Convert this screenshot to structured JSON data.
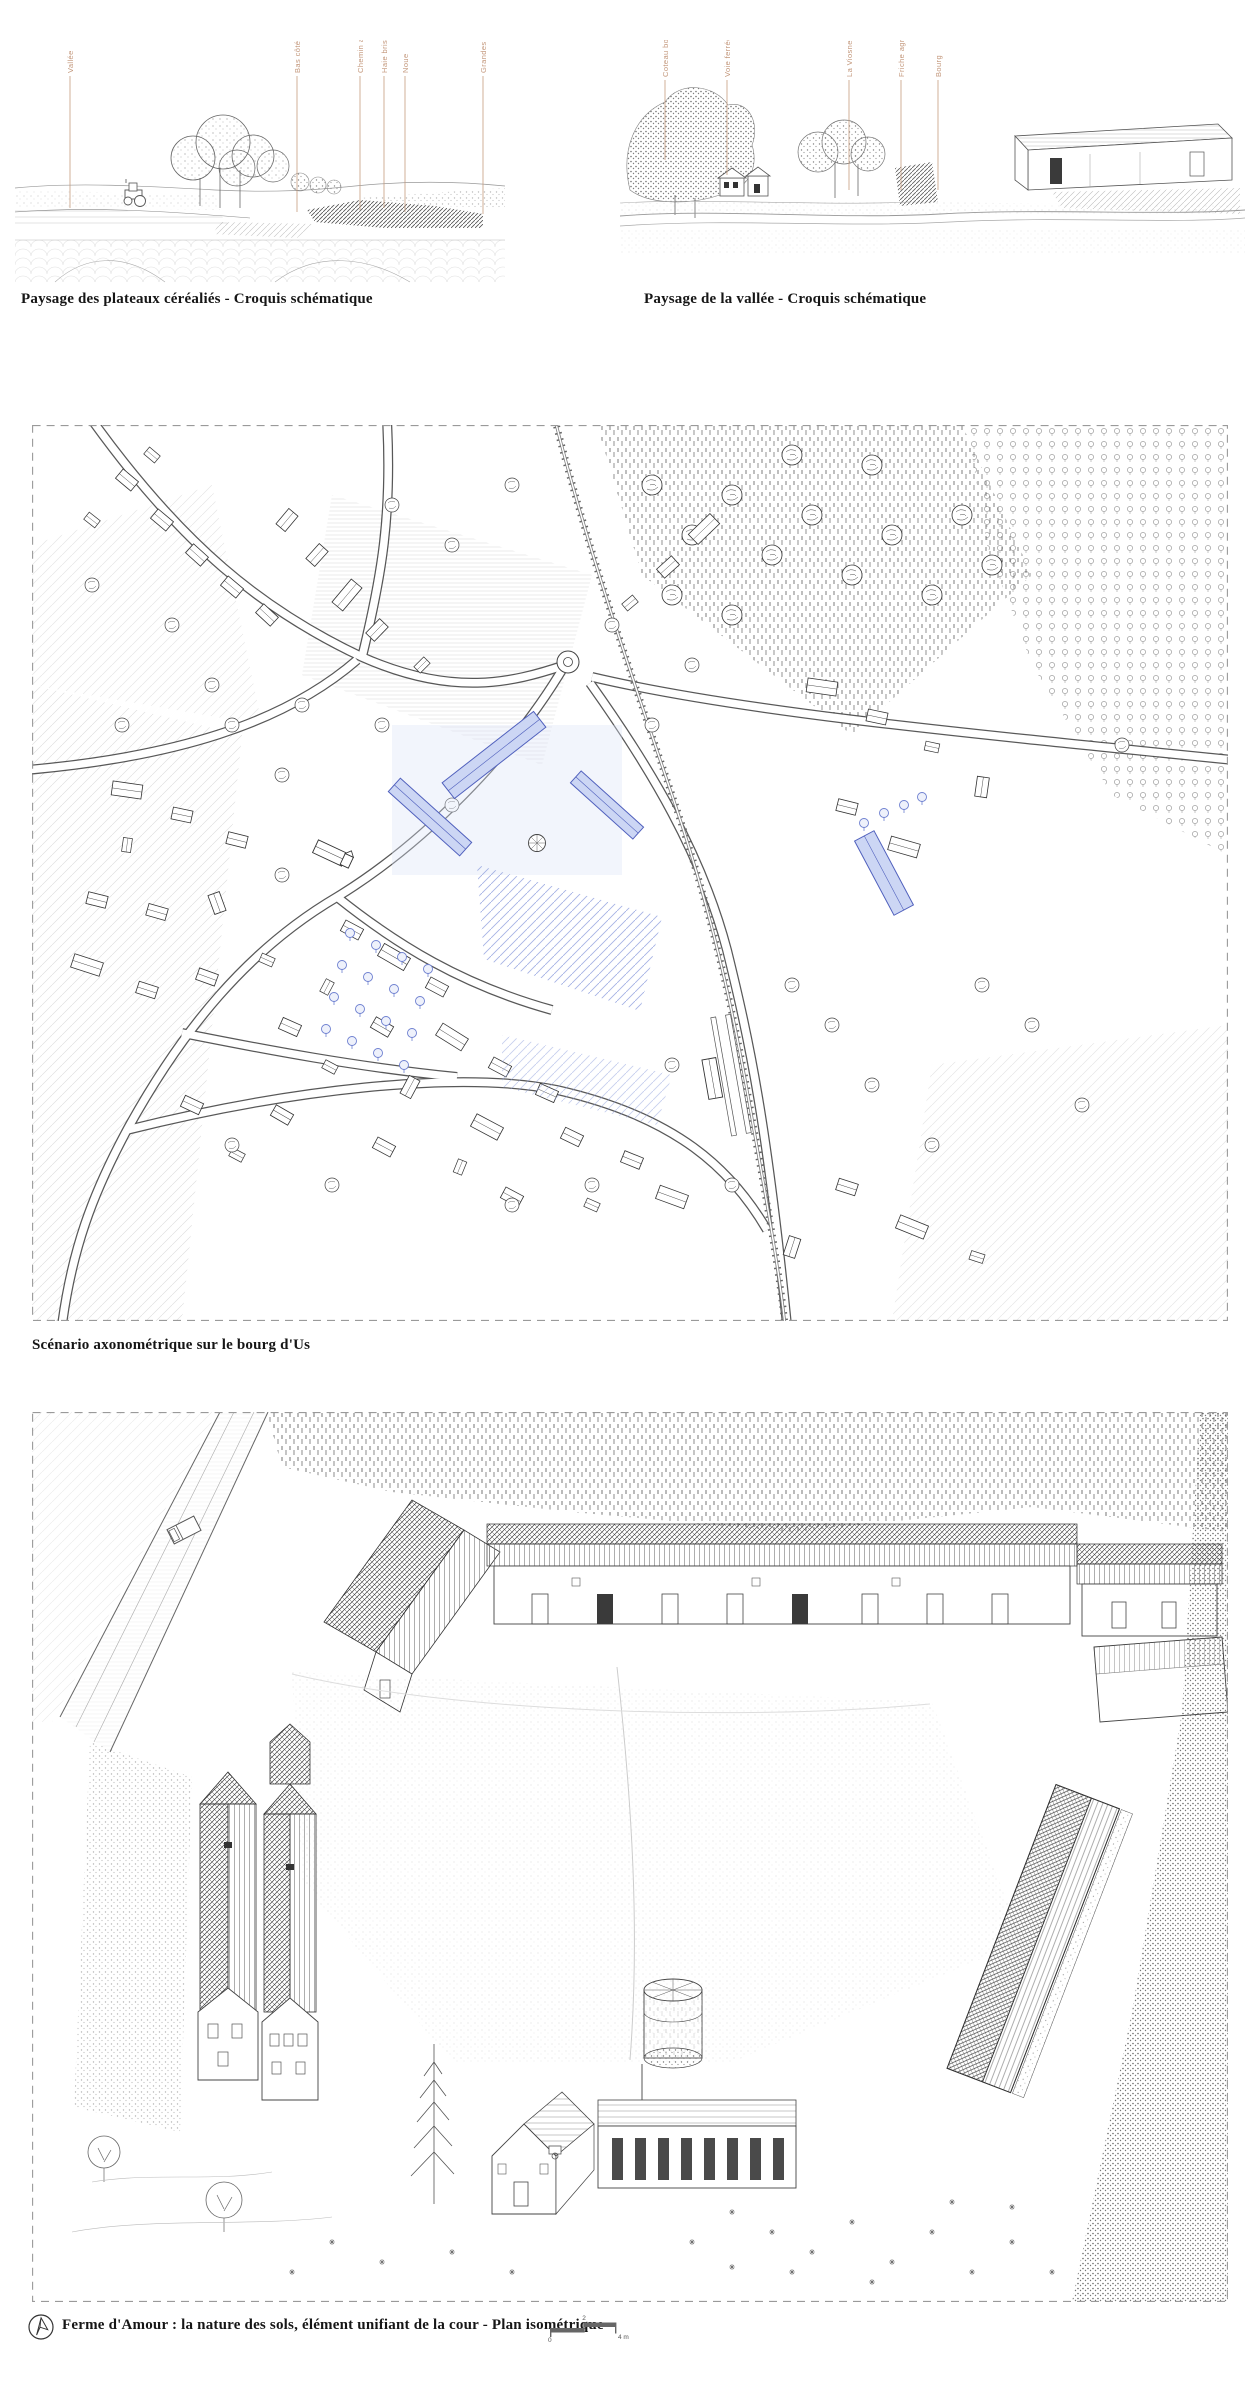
{
  "sketches": {
    "left": {
      "caption": "Paysage des plateaux céréaliés - Croquis schématique",
      "labels": [
        "Vallée",
        "Bas côté",
        "Chemin agricole",
        "Haie brise-vent",
        "Noue",
        "Grandes cultures"
      ]
    },
    "right": {
      "caption": "Paysage de la vallée - Croquis schématique",
      "labels": [
        "Coteau boisé",
        "Voie ferrée",
        "La Viosne",
        "Friche agricole",
        "Bourg"
      ]
    }
  },
  "axonometric": {
    "caption": "Scénario axonométrique sur le bourg d'Us"
  },
  "isometric": {
    "caption": "Ferme d'Amour : la nature des sols, élément unifiant de la cour - Plan isométrique",
    "scale_bar": {
      "zero": "0",
      "mid": "2",
      "end": "4 m"
    }
  },
  "colors": {
    "ink": "#161616",
    "annotation_tan": "#c3977b",
    "highlight_blue": "#5060bd",
    "highlight_blue_fill": "#ccd6f4",
    "dashed_border": "#9a9a9a"
  }
}
